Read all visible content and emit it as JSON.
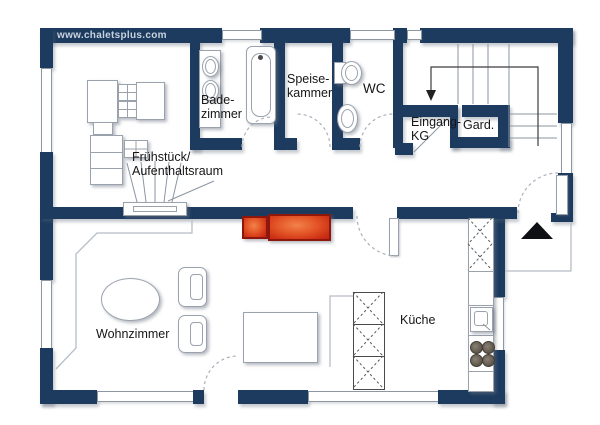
{
  "site": {
    "url": "www.chaletsplus.com"
  },
  "rooms": {
    "badezimmer": {
      "label": "Bade-\nzimmer"
    },
    "speisekammer": {
      "label": "Speise-\nkammer"
    },
    "wc": {
      "label": "WC"
    },
    "eingang_kg": {
      "label": "Eingang-\nKG"
    },
    "garderobe": {
      "label": "Gard."
    },
    "fruehstueck": {
      "label": "Frühstück/\nAufenthaltsraum"
    },
    "wohnzimmer": {
      "label": "Wohnzimmer"
    },
    "kueche": {
      "label": "Küche"
    }
  },
  "colors": {
    "wall": "#1c3b5f",
    "red_dark": "#8f160b",
    "line": "#9aa3ad",
    "thin": "#b7bec7",
    "text": "#161616",
    "url_text": "#c9d3dd"
  }
}
